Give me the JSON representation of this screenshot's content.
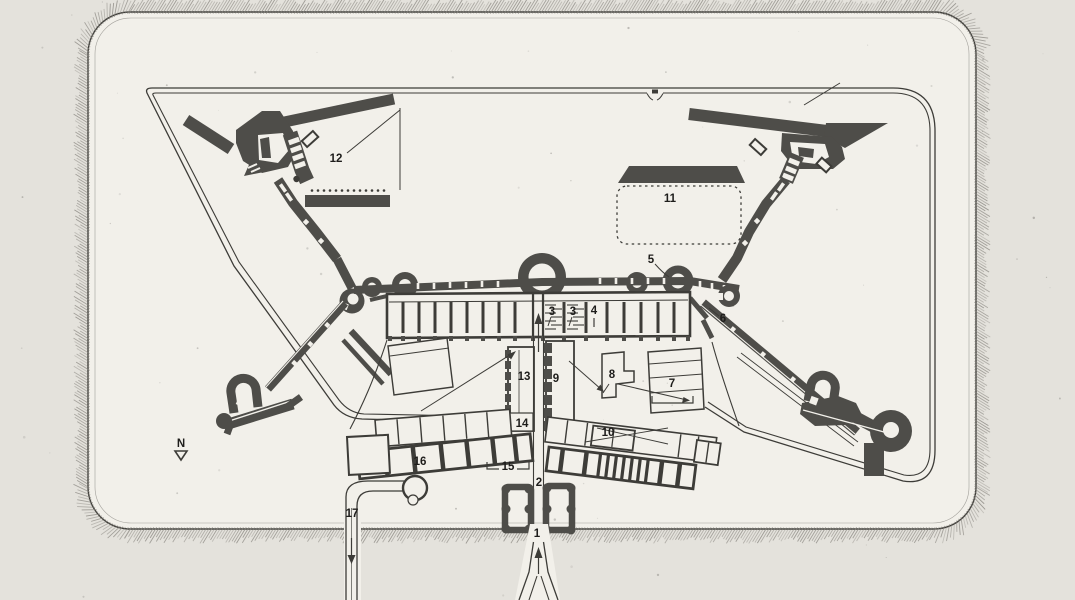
{
  "figure": {
    "kind": "scanned fortification ground plan",
    "compass": {
      "label": "N"
    }
  },
  "colors": {
    "background": "#e4e2dc",
    "paper": "#f2f0ea",
    "ink": "#3d3c38",
    "dark_fill": "#4e4d49",
    "hatch": "#8a8781",
    "label_ink": "#1e1d1b"
  },
  "plan": {
    "labels": [
      {
        "id": "1",
        "text": "1",
        "x": 537,
        "y": 537
      },
      {
        "id": "2",
        "text": "2",
        "x": 539,
        "y": 486
      },
      {
        "id": "3a",
        "text": "3",
        "x": 552,
        "y": 315
      },
      {
        "id": "3b",
        "text": "3",
        "x": 573,
        "y": 315
      },
      {
        "id": "4",
        "text": "4",
        "x": 594,
        "y": 314
      },
      {
        "id": "5",
        "text": "5",
        "x": 651,
        "y": 263
      },
      {
        "id": "6",
        "text": "6",
        "x": 723,
        "y": 322
      },
      {
        "id": "7",
        "text": "7",
        "x": 672,
        "y": 387
      },
      {
        "id": "8",
        "text": "8",
        "x": 612,
        "y": 378
      },
      {
        "id": "9",
        "text": "9",
        "x": 556,
        "y": 382
      },
      {
        "id": "10",
        "text": "10",
        "x": 608,
        "y": 436
      },
      {
        "id": "11",
        "text": "11",
        "x": 670,
        "y": 202
      },
      {
        "id": "12",
        "text": "12",
        "x": 336,
        "y": 162
      },
      {
        "id": "13",
        "text": "13",
        "x": 524,
        "y": 380
      },
      {
        "id": "14",
        "text": "14",
        "x": 522,
        "y": 427
      },
      {
        "id": "15",
        "text": "15",
        "x": 508,
        "y": 470
      },
      {
        "id": "16",
        "text": "16",
        "x": 420,
        "y": 465
      },
      {
        "id": "17",
        "text": "17",
        "x": 352,
        "y": 517
      },
      {
        "id": "north",
        "text": "N",
        "x": 181,
        "y": 447
      }
    ]
  }
}
